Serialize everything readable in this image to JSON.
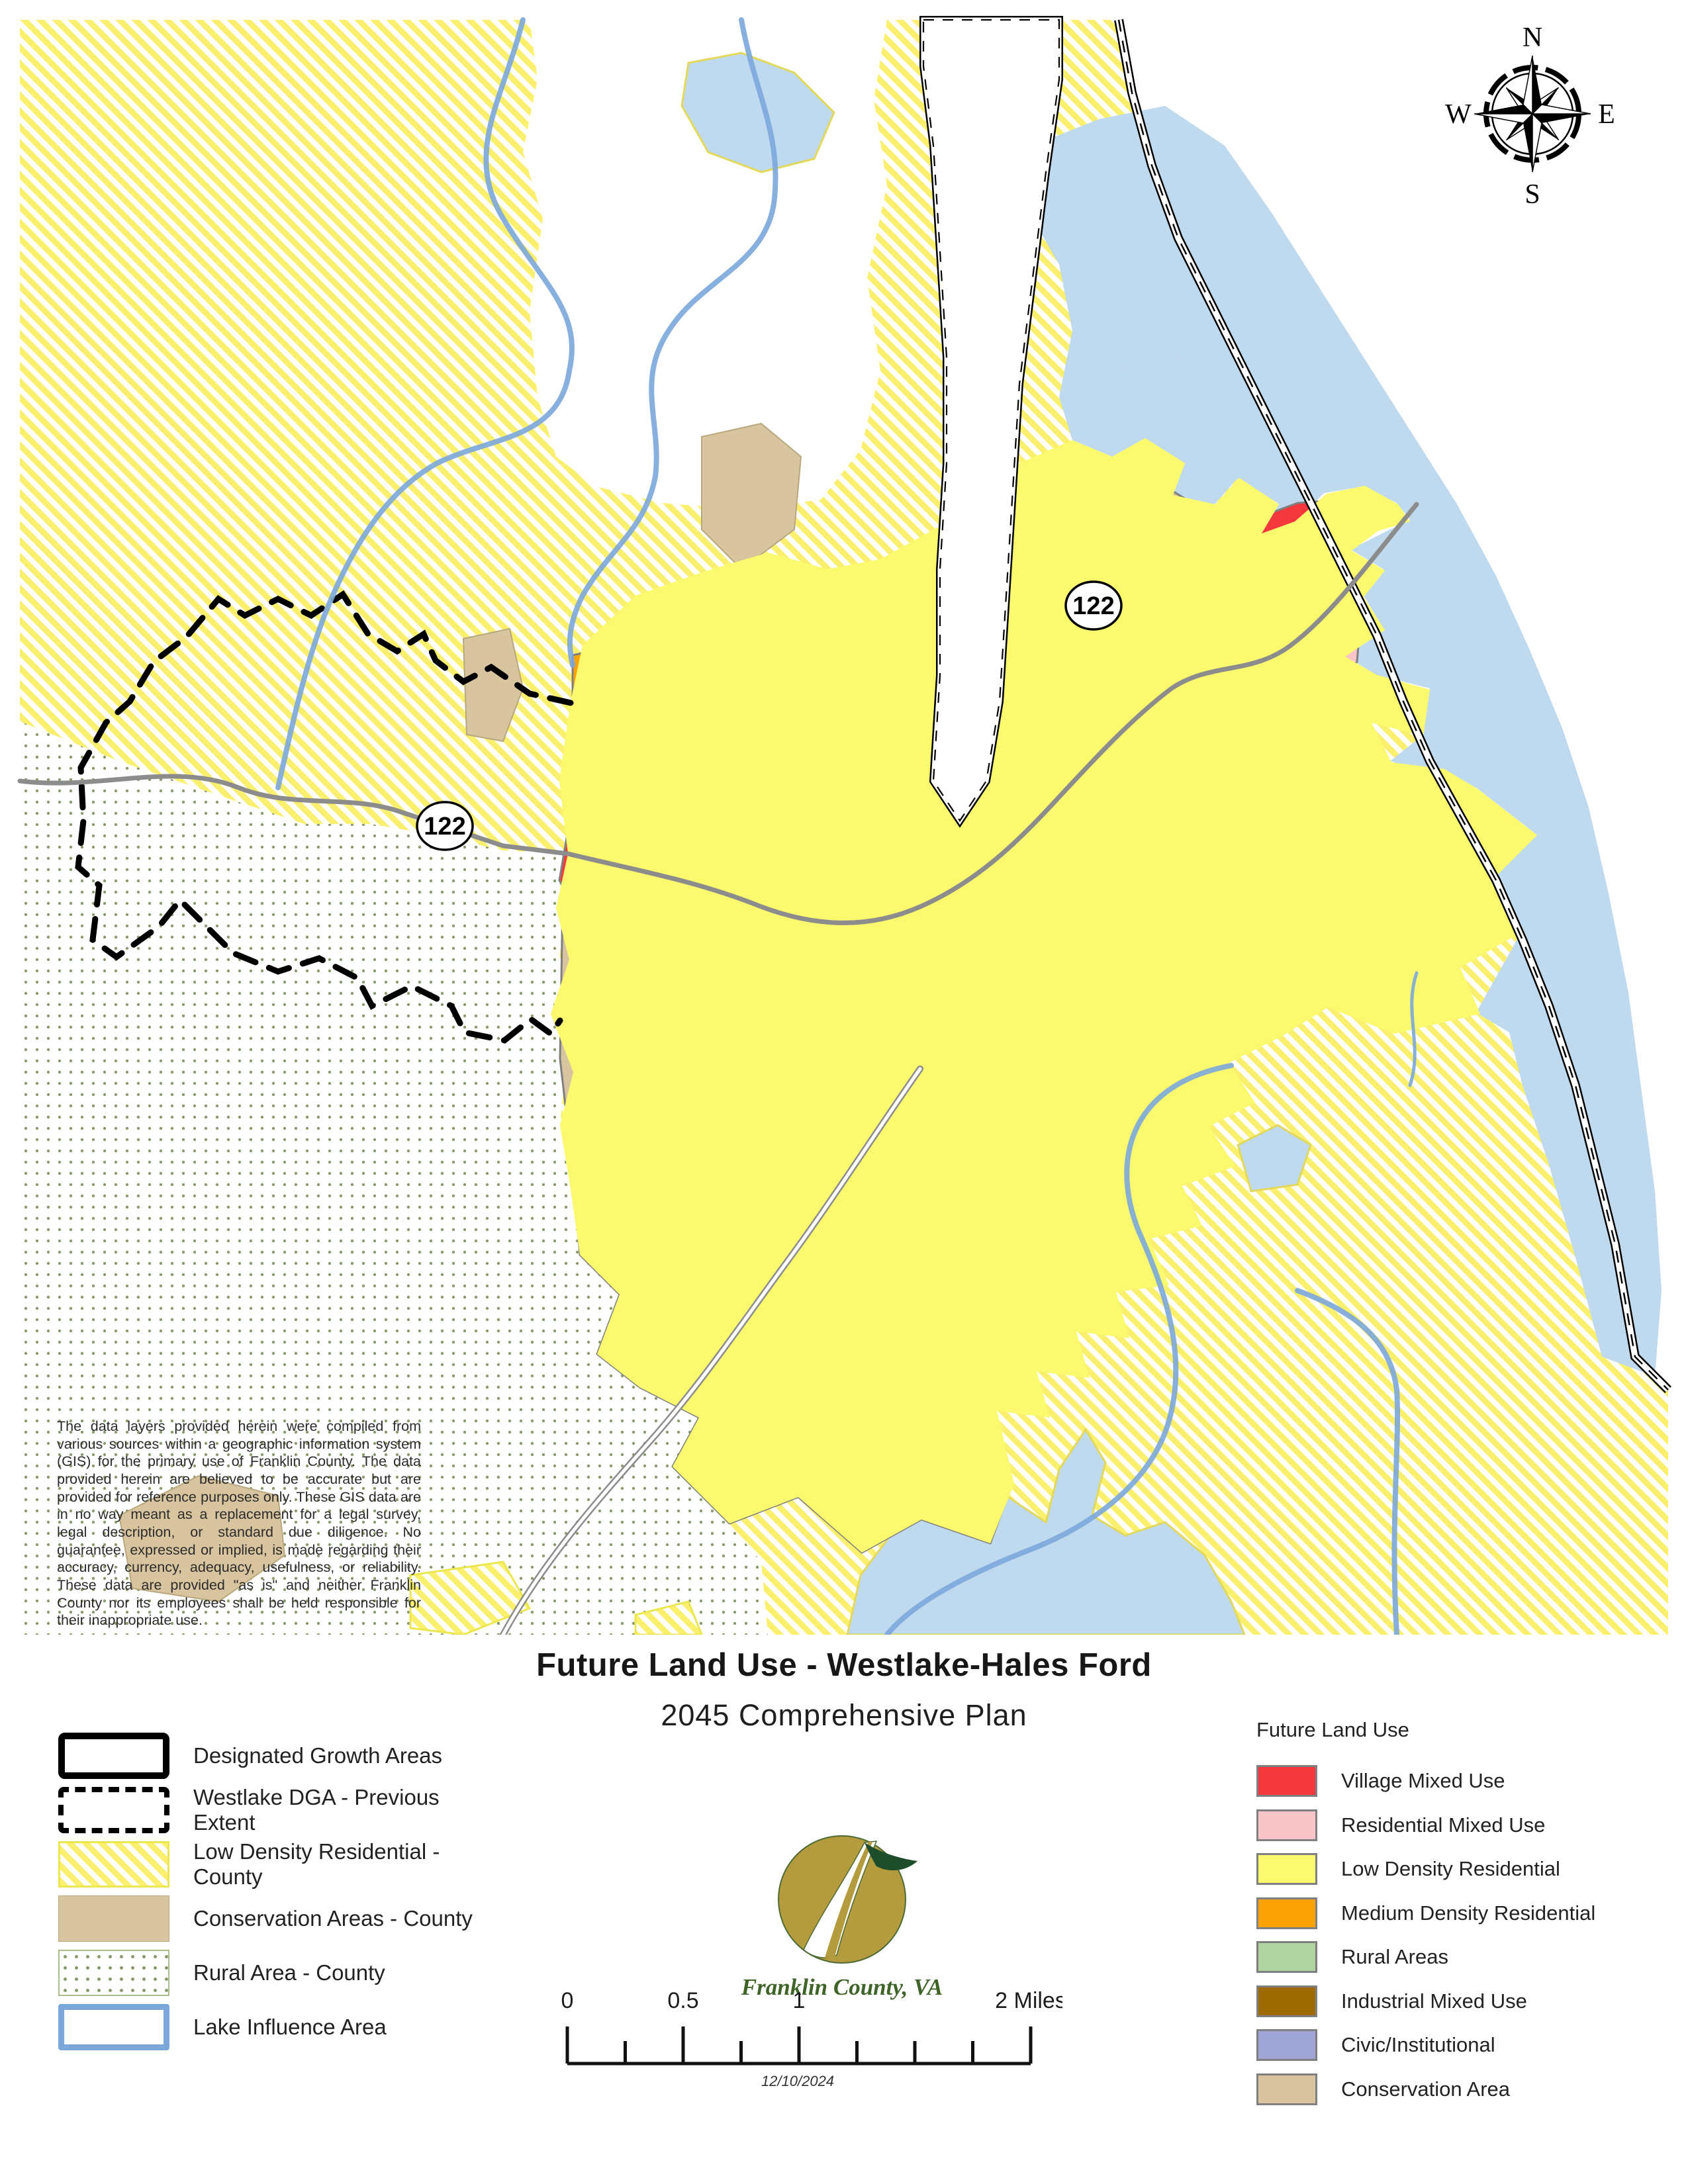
{
  "title": {
    "line1": "Future Land Use - Westlake-Hales Ford",
    "line2": "2045 Comprehensive Plan"
  },
  "map": {
    "route_shield": "122",
    "compass": {
      "n": "N",
      "e": "E",
      "s": "S",
      "w": "W"
    },
    "disclaimer": "The data layers provided herein were compiled from various sources within a geographic information system (GIS) for the primary use of Franklin County. The data provided herein are believed to be accurate but are provided for reference purposes only. These GIS data are in no way meant as a replacement for a legal survey, legal description, or standard due diligence. No guarantee, expressed or implied, is made regarding their accuracy, currency, adequacy, usefulness, or reliability. These data are provided \"as is\" and neither Franklin County nor its employees shall be held responsible for their inappropriate use."
  },
  "legend_left": {
    "items": [
      {
        "label": "Designated Growth Areas"
      },
      {
        "label": "Westlake DGA - Previous Extent"
      },
      {
        "label": "Low Density Residential - County"
      },
      {
        "label": "Conservation Areas - County"
      },
      {
        "label": "Rural Area - County"
      },
      {
        "label": "Lake Influence Area"
      }
    ]
  },
  "legend_right": {
    "header": "Future Land Use",
    "items": [
      {
        "label": "Village Mixed Use",
        "color": "#f5383d"
      },
      {
        "label": "Residential Mixed Use",
        "color": "#f8c4c8"
      },
      {
        "label": "Low Density Residential",
        "color": "#fbfa6e"
      },
      {
        "label": "Medium Density Residential",
        "color": "#fca406"
      },
      {
        "label": "Rural Areas",
        "color": "#b1d3a1"
      },
      {
        "label": "Industrial Mixed Use",
        "color": "#9e6b02"
      },
      {
        "label": "Civic/Institutional",
        "color": "#9fa6d6"
      },
      {
        "label": "Conservation Area",
        "color": "#d8c49e"
      }
    ]
  },
  "logo": {
    "caption": "Franklin County, VA"
  },
  "scalebar": {
    "labels": [
      "0",
      "0.5",
      "1",
      "2 Miles"
    ],
    "date": "12/10/2024"
  },
  "colors": {
    "water": "#bfd9ef",
    "hatch_stripe": "#faf06e",
    "rural_dots": "#8a9b6e",
    "lake_influence_line": "#7ba7db",
    "road": "#8c8c8c",
    "dga_boundary": "#000000",
    "logo_gold": "#b39b3e",
    "logo_green": "#1e4d2b",
    "county_text_green": "#3e6428"
  }
}
